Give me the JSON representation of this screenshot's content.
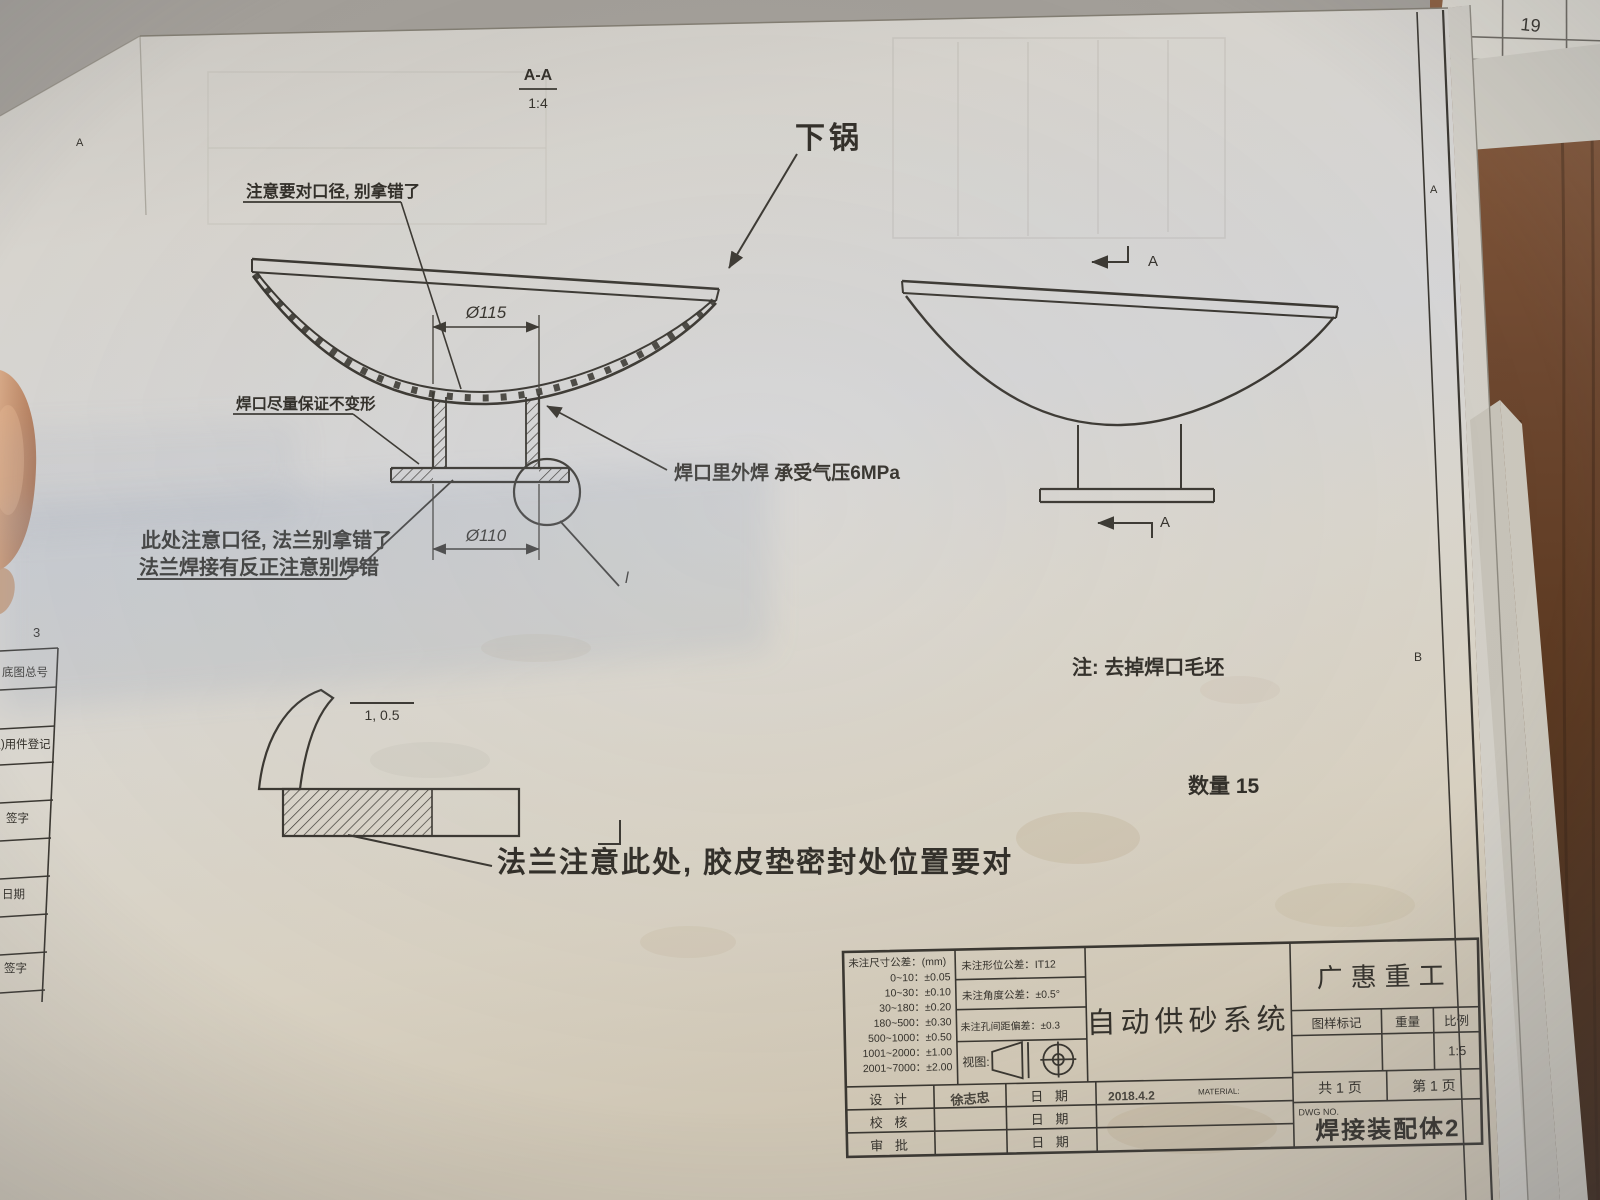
{
  "page": {
    "zone_letters": {
      "top_left": "A",
      "left_mid": "3",
      "right_top": "A",
      "right_mid": "B"
    },
    "under_sheet_number": "19",
    "left_margin_rows": [
      "底图总号",
      "借(通)用件登记",
      "签字",
      "日期",
      "签字"
    ]
  },
  "views": {
    "section_label": "A-A",
    "section_scale": "1:4",
    "part_label": "下锅",
    "detail_mark": "l",
    "dim_top": "Ø115",
    "dim_bottom": "Ø110",
    "surface_finish": "1, 0.5"
  },
  "notes": {
    "rim_note": "注意要对口径, 别拿错了",
    "weld_no_deform": "焊口尽量保证不变形",
    "bore_note_line1": "此处注意口径, 法兰别拿错了",
    "bore_note_line2": "法兰焊接有反正注意别焊错",
    "weld_pressure": "焊口里外焊 承受气压6MPa",
    "deburr_note": "注: 去掉焊口毛坯",
    "quantity": "数量 15",
    "gasket_note": "法兰注意此处, 胶皮垫密封处位置要对"
  },
  "title_block": {
    "dim_tol_header": "未注尺寸公差：(mm)",
    "dim_tols": [
      "0~10：±0.05",
      "10~30：±0.10",
      "30~180：±0.20",
      "180~500：±0.30",
      "500~1000：±0.50",
      "1001~2000：±1.00",
      "2001~7000：±2.00"
    ],
    "geo_tol": "未注形位公差：IT12",
    "angle_tol": "未注角度公差：±0.5°",
    "hole_tol": "未注孔间距偏差：±0.3",
    "view_label": "视图:",
    "sign_rows": [
      {
        "label": "设 计",
        "name": "徐志忠",
        "date_label": "日 期",
        "date": "2018.4.2",
        "extra": "MATERIAL:"
      },
      {
        "label": "校 核",
        "name": "",
        "date_label": "日 期",
        "date": "",
        "extra": ""
      },
      {
        "label": "审 批",
        "name": "",
        "date_label": "日 期",
        "date": "",
        "extra": ""
      }
    ],
    "project_name": "自动供砂系统",
    "company": "广惠重工",
    "col_mark": "图样标记",
    "col_weight": "重量",
    "col_scale": "比例",
    "scale_value": "1:5",
    "pages_total": "共 1 页",
    "page_no": "第 1 页",
    "dwg_no_label": "DWG NO.",
    "drawing_title": "焊接装配体2"
  }
}
